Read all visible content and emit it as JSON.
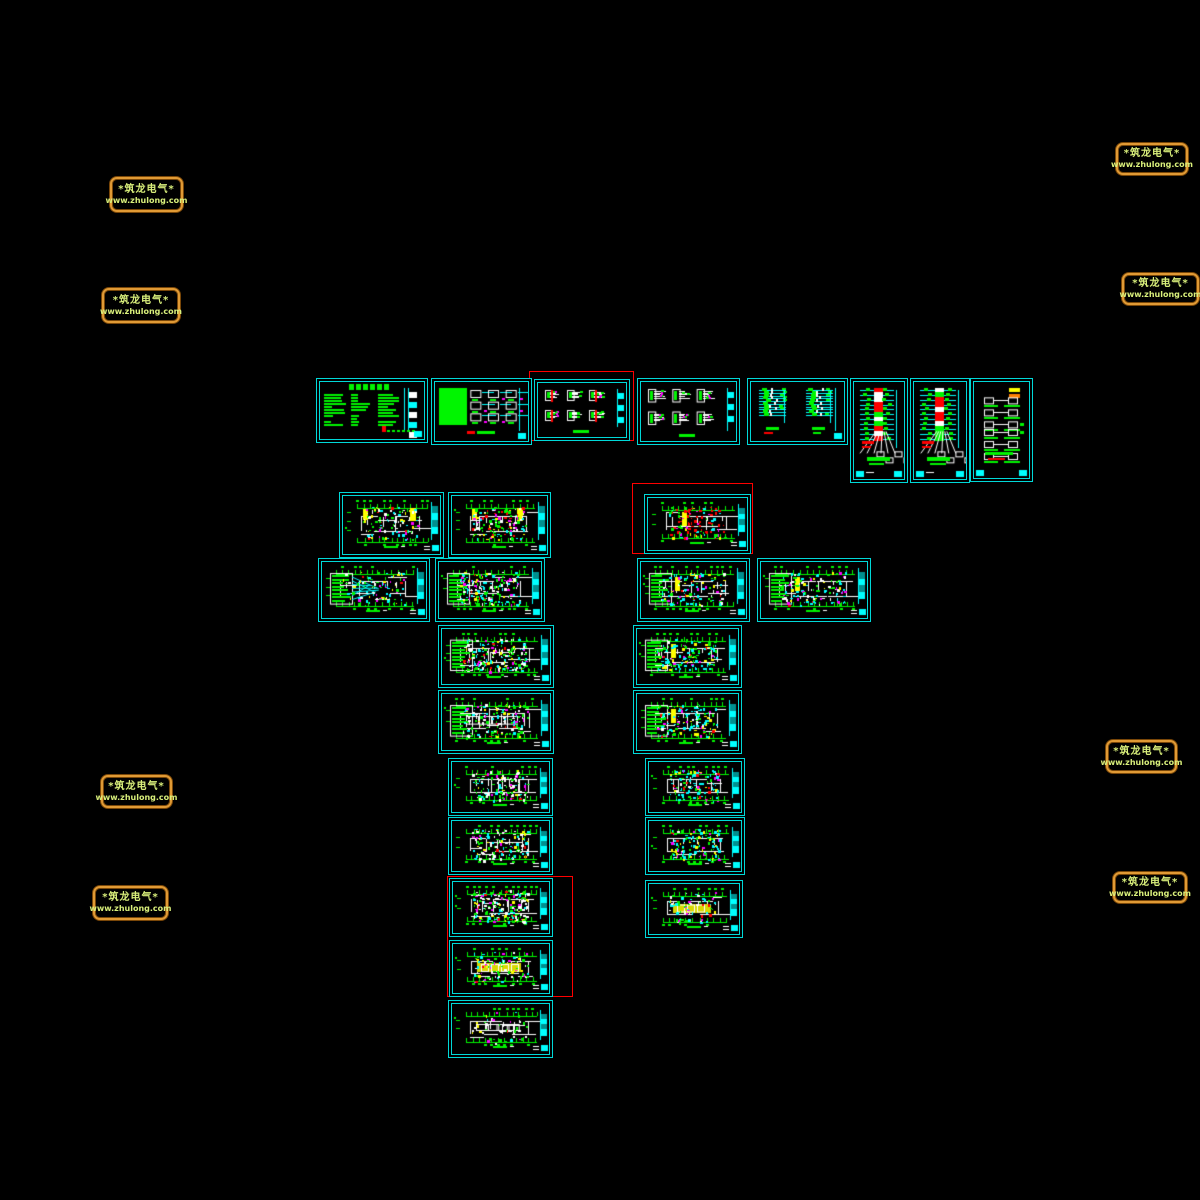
{
  "app": {
    "type": "cad-model-space",
    "background": "#000000"
  },
  "palette": {
    "sheet_border": "#00d9d9",
    "cyan": "#00ffff",
    "green": "#00f500",
    "red": "#ff0000",
    "yellow": "#ffff00",
    "orange": "#ff8000",
    "magenta": "#ff00ff",
    "white": "#ffffff",
    "dimcyan": "#008f8f",
    "highlight": "#ff0000",
    "watermark_border": "#e09a35",
    "watermark_text": "#d9ef7b"
  },
  "watermark_text": {
    "line1": "*筑龙电气*",
    "line2": "www.zhulong.com"
  },
  "watermarks": [
    {
      "x": 110,
      "y": 177,
      "w": 73,
      "h": 35
    },
    {
      "x": 102,
      "y": 288,
      "w": 78,
      "h": 35
    },
    {
      "x": 101,
      "y": 775,
      "w": 71,
      "h": 33
    },
    {
      "x": 93,
      "y": 886,
      "w": 75,
      "h": 34
    },
    {
      "x": 1116,
      "y": 143,
      "w": 72,
      "h": 32
    },
    {
      "x": 1122,
      "y": 273,
      "w": 77,
      "h": 32
    },
    {
      "x": 1106,
      "y": 740,
      "w": 71,
      "h": 33
    },
    {
      "x": 1113,
      "y": 872,
      "w": 74,
      "h": 31
    }
  ],
  "highlight_boxes": [
    {
      "x": 529,
      "y": 371,
      "w": 105,
      "h": 70
    },
    {
      "x": 632,
      "y": 483,
      "w": 121,
      "h": 71
    },
    {
      "x": 447,
      "y": 876,
      "w": 126,
      "h": 121
    }
  ],
  "sheets": [
    {
      "id": "notes",
      "x": 316,
      "y": 378,
      "w": 112,
      "h": 65,
      "kind": "notes",
      "seed": 101,
      "opts": {}
    },
    {
      "id": "legend",
      "x": 431,
      "y": 378,
      "w": 101,
      "h": 67,
      "kind": "legend",
      "seed": 102,
      "opts": {}
    },
    {
      "id": "dist-1",
      "x": 534,
      "y": 379,
      "w": 96,
      "h": 62,
      "kind": "dist",
      "seed": 103,
      "opts": {
        "redlines": true
      }
    },
    {
      "id": "dist-2",
      "x": 637,
      "y": 378,
      "w": 103,
      "h": 67,
      "kind": "dist",
      "seed": 104,
      "opts": {
        "redlines": false
      }
    },
    {
      "id": "riser-pair",
      "x": 747,
      "y": 378,
      "w": 101,
      "h": 67,
      "kind": "riserpair",
      "seed": 105,
      "opts": {}
    },
    {
      "id": "riser-1",
      "x": 850,
      "y": 378,
      "w": 58,
      "h": 105,
      "kind": "risertall",
      "seed": 106,
      "opts": {}
    },
    {
      "id": "riser-2",
      "x": 910,
      "y": 378,
      "w": 60,
      "h": 105,
      "kind": "risertall",
      "seed": 107,
      "opts": {}
    },
    {
      "id": "feeder",
      "x": 970,
      "y": 378,
      "w": 63,
      "h": 104,
      "kind": "feeder",
      "seed": 108,
      "opts": {}
    },
    {
      "id": "plan-01",
      "x": 339,
      "y": 492,
      "w": 105,
      "h": 66,
      "kind": "plan",
      "seed": 11,
      "opts": {
        "count": 110,
        "cyan": 0.22,
        "yellowEnds": true
      }
    },
    {
      "id": "plan-02",
      "x": 448,
      "y": 492,
      "w": 103,
      "h": 66,
      "kind": "plan",
      "seed": 12,
      "opts": {
        "count": 150,
        "red": 0.12,
        "yellowEnds": true
      }
    },
    {
      "id": "plan-03",
      "x": 644,
      "y": 494,
      "w": 107,
      "h": 60,
      "kind": "plan",
      "seed": 13,
      "opts": {
        "count": 110,
        "red": 0.42,
        "yellowLeft": true
      }
    },
    {
      "id": "plan-04",
      "x": 318,
      "y": 558,
      "w": 112,
      "h": 64,
      "kind": "plan",
      "seed": 14,
      "opts": {
        "count": 95,
        "cyan": 0.3,
        "leftStack": true,
        "fan": true
      }
    },
    {
      "id": "plan-05",
      "x": 435,
      "y": 558,
      "w": 110,
      "h": 64,
      "kind": "plan",
      "seed": 15,
      "opts": {
        "count": 200,
        "cyan": 0.3,
        "leftStack": true
      }
    },
    {
      "id": "plan-06",
      "x": 637,
      "y": 558,
      "w": 113,
      "h": 64,
      "kind": "plan",
      "seed": 16,
      "opts": {
        "count": 120,
        "cyan": 0.35,
        "leftStack": true,
        "yellowLeft": true
      }
    },
    {
      "id": "plan-07",
      "x": 757,
      "y": 558,
      "w": 114,
      "h": 64,
      "kind": "plan",
      "seed": 17,
      "opts": {
        "count": 130,
        "cyan": 0.35,
        "leftStack": true,
        "yellowLeft": true
      }
    },
    {
      "id": "plan-08",
      "x": 438,
      "y": 625,
      "w": 116,
      "h": 63,
      "kind": "plan",
      "seed": 18,
      "opts": {
        "count": 210,
        "cyan": 0.25,
        "leftStack": true
      }
    },
    {
      "id": "plan-09",
      "x": 633,
      "y": 625,
      "w": 109,
      "h": 63,
      "kind": "plan",
      "seed": 19,
      "opts": {
        "count": 140,
        "cyan": 0.45,
        "leftStack": true,
        "yellowLeft": true
      }
    },
    {
      "id": "plan-10",
      "x": 438,
      "y": 690,
      "w": 116,
      "h": 64,
      "kind": "plan",
      "seed": 20,
      "opts": {
        "count": 150,
        "leftStack": true,
        "rooms": true
      }
    },
    {
      "id": "plan-11",
      "x": 633,
      "y": 690,
      "w": 109,
      "h": 64,
      "kind": "plan",
      "seed": 21,
      "opts": {
        "count": 140,
        "cyan": 0.4,
        "leftStack": true,
        "yellowLeft": true
      }
    },
    {
      "id": "plan-12",
      "x": 448,
      "y": 758,
      "w": 105,
      "h": 58,
      "kind": "plan",
      "seed": 22,
      "opts": {
        "count": 130
      }
    },
    {
      "id": "plan-13",
      "x": 645,
      "y": 758,
      "w": 100,
      "h": 58,
      "kind": "plan",
      "seed": 23,
      "opts": {
        "count": 120,
        "cyan": 0.45
      }
    },
    {
      "id": "plan-14",
      "x": 448,
      "y": 817,
      "w": 105,
      "h": 58,
      "kind": "plan",
      "seed": 24,
      "opts": {
        "count": 140
      }
    },
    {
      "id": "plan-15",
      "x": 645,
      "y": 817,
      "w": 100,
      "h": 58,
      "kind": "plan",
      "seed": 25,
      "opts": {
        "count": 130,
        "cyan": 0.4,
        "yellow": 0.18
      }
    },
    {
      "id": "plan-16",
      "x": 449,
      "y": 878,
      "w": 104,
      "h": 59,
      "kind": "plan",
      "seed": 26,
      "opts": {
        "count": 190
      }
    },
    {
      "id": "plan-17",
      "x": 645,
      "y": 880,
      "w": 98,
      "h": 58,
      "kind": "plan",
      "seed": 27,
      "opts": {
        "count": 70,
        "cyan": 0.3,
        "yellowBand": true
      }
    },
    {
      "id": "plan-18",
      "x": 449,
      "y": 940,
      "w": 104,
      "h": 57,
      "kind": "plan",
      "seed": 28,
      "opts": {
        "count": 90,
        "yellowBand": true
      }
    },
    {
      "id": "plan-19",
      "x": 448,
      "y": 1000,
      "w": 105,
      "h": 58,
      "kind": "plan",
      "seed": 29,
      "opts": {
        "count": 45,
        "cyan": 0.1,
        "rooms": true
      }
    }
  ]
}
